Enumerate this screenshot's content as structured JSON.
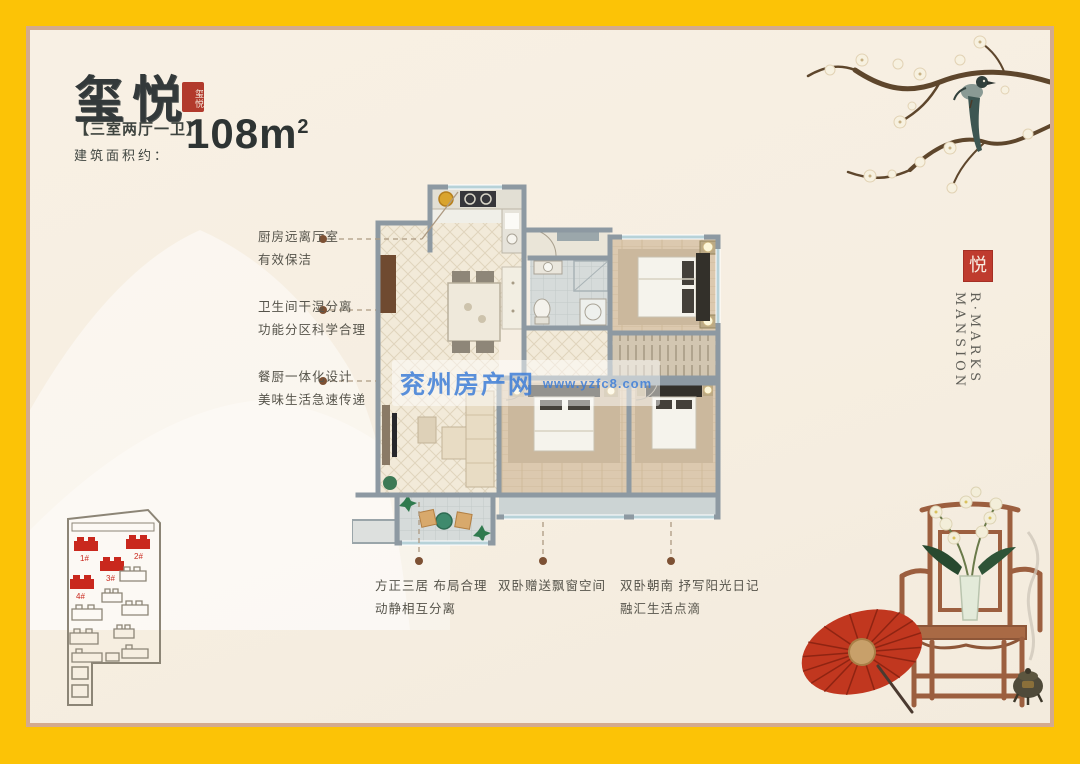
{
  "frame": {
    "border_color": "#fcc306",
    "inner_line_color": "#d3aa8e",
    "panel_bg": "#f6efe2"
  },
  "header": {
    "title": "玺悦",
    "title_seal": "玺悦",
    "spec": "【三室两厅一卫】",
    "area_label": "建筑面积约：",
    "area_value": "108m",
    "area_sup": "2"
  },
  "callouts_left": [
    {
      "line1": "厨房远离厅室",
      "line2": "有效保洁"
    },
    {
      "line1": "卫生间干湿分离",
      "line2": "功能分区科学合理"
    },
    {
      "line1": "餐厨一体化设计",
      "line2": "美味生活急速传递"
    }
  ],
  "callouts_bottom": [
    {
      "line1": "方正三居 布局合理",
      "line2": "动静相互分离"
    },
    {
      "line1": "双卧赠送飘窗空间",
      "line2": ""
    },
    {
      "line1": "双卧朝南 抒写阳光日记",
      "line2": "融汇生活点滴"
    }
  ],
  "watermark": {
    "site_name": "兖州房产网",
    "site_url": "www.yzfc8.com",
    "color": "#3e7ed8"
  },
  "brand": {
    "seal": "悦",
    "line1": "R·MARKS",
    "line2": "MANSION"
  },
  "site_plan": {
    "highlight_color": "#c9281d",
    "buildings": [
      {
        "label": "1#"
      },
      {
        "label": "2#"
      },
      {
        "label": "3#"
      },
      {
        "label": "4#"
      }
    ]
  }
}
